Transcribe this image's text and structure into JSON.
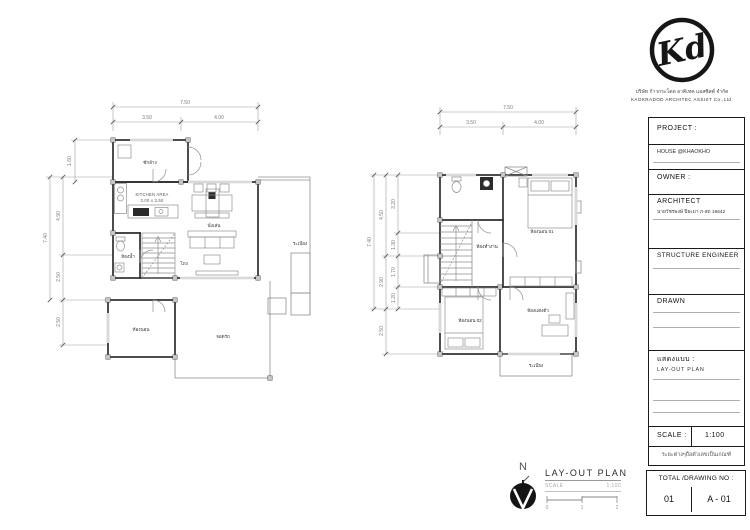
{
  "logo": {
    "monogram": "Kd",
    "company_th": "บริษัท ก้าวกระโดด อาคิเทค แอสซิสต์ จำกัด",
    "company_en": "KAOKRADOD  ARCHITEC  ASSIST  Co.,Ltd."
  },
  "title_block": {
    "project_label": "PROJECT :",
    "project_value": "HOUSE   @KHAOKHO",
    "owner_label": "OWNER :",
    "architect_label": "ARCHITECT",
    "architect_value": "นายวัชรพงษ์  ปิยะมา  ภ-สถ 19642",
    "structure_label": "STRUCTURE ENGINEER",
    "drawn_label": "DRAWN",
    "sheet_type_label": "แสดงแบบ :",
    "sheet_type_value": "LAY-OUT   PLAN",
    "scale_label": "SCALE :",
    "scale_value": "1:100",
    "note": "ระยะต่างๆถือตัวเลขเป็นเกณฑ์",
    "total_label": "TOTAL /DRAWING NO :",
    "sheet_count": "01",
    "drawing_no": "A - 01"
  },
  "legend": {
    "north_label": "N",
    "title": "LAY-OUT  PLAN",
    "scale_label": "SCALE",
    "scale_value": "1:100",
    "bar_ticks": [
      "0",
      "1",
      "2"
    ]
  },
  "plan1": {
    "dims": {
      "top_total": "7.50",
      "top_seg1": "3.50",
      "top_seg2": "4.00",
      "left_offset": "1.60",
      "left_total": "7.40",
      "left_seg1": "4.90",
      "left_seg2": "2.50",
      "left_seg3": "2.50"
    },
    "labels": {
      "laundry": "ซักล้าง",
      "kitchen1": "KITCHEN AREA",
      "kitchen2": "3.00 x 3.50",
      "living": "นั่งเล่น",
      "hall": "โถง",
      "bath": "ห้องน้ำ",
      "bedroom": "ห้องนอน",
      "carport": "จอดรถ",
      "porch": "ระเบียง"
    }
  },
  "plan2": {
    "dims": {
      "top_total": "7.50",
      "top_seg1": "3.50",
      "top_seg2": "4.00",
      "left_total": "7.40",
      "mid_seg1": "4.50",
      "mid_seg2": "2.90",
      "mid_seg3": "2.50",
      "inner_seg1": "3.20",
      "inner_seg2": "1.30",
      "inner_seg3": "1.70",
      "inner_seg4": "1.20"
    },
    "labels": {
      "office": "ห้องทำงาน",
      "bedroom1": "ห้องนอน 01",
      "bedroom2": "ห้องนอน 02",
      "dressing": "ห้องแต่งตัว",
      "balcony": "ระเบียง"
    }
  }
}
